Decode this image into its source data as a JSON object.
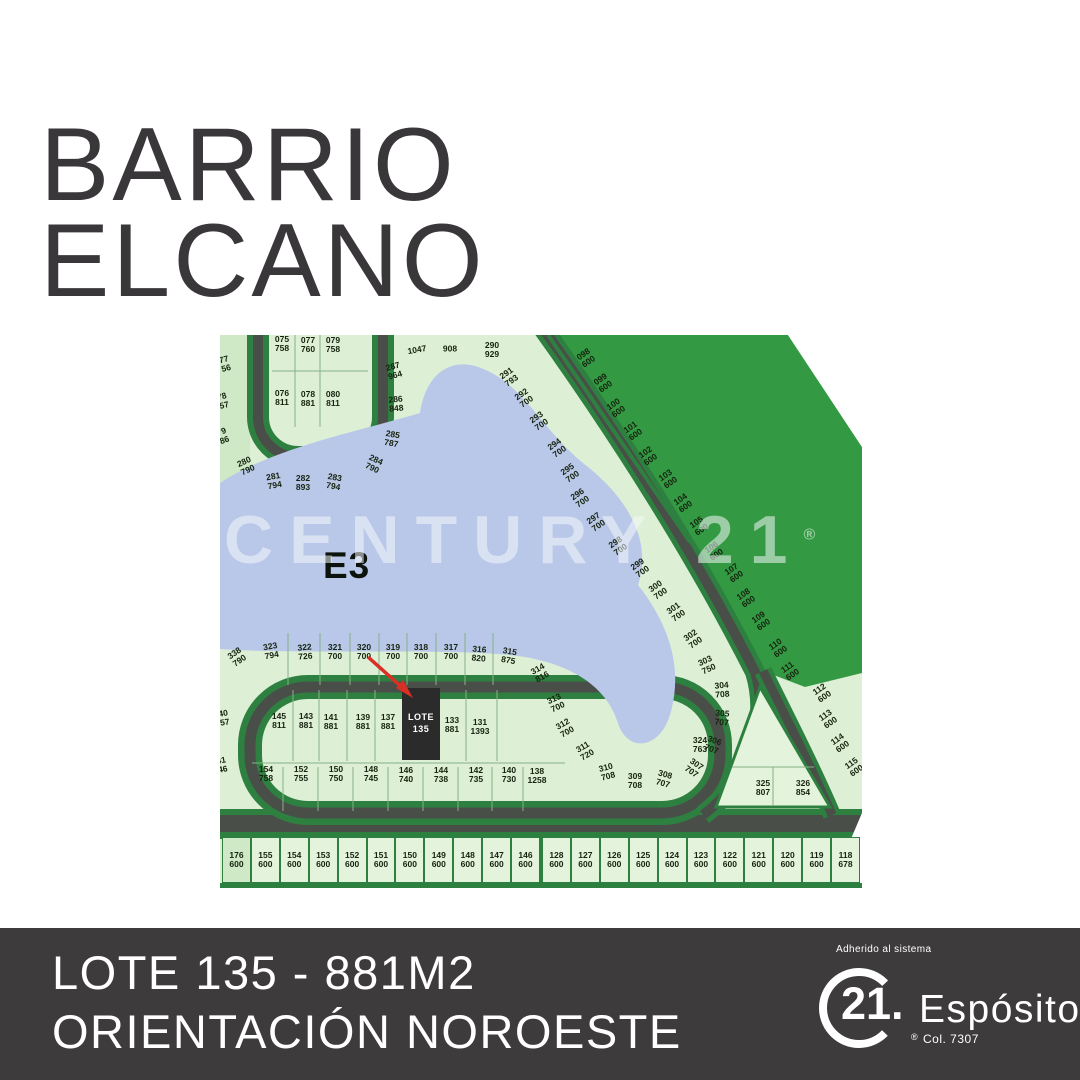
{
  "title": {
    "line1": "BARRIO",
    "line2": "ELCANO"
  },
  "footer": {
    "line1": "LOTE 135 - 881M2",
    "line2": "ORIENTACIÓN NOROESTE",
    "adherido": "Adherido al sistema",
    "brand": "21.",
    "registered": "®",
    "brand_name": "Espósito",
    "license": "Col. 7307"
  },
  "colors": {
    "page_bg": "#ffffff",
    "title_color": "#3a373a",
    "footer_bg": "#3e3b3c",
    "footer_text": "#ffffff",
    "map_base": "#ddefd5",
    "lot_fill": "#e4f3dc",
    "park_green": "#339a43",
    "road_gray": "#4a4e48",
    "road_green": "#2e8040",
    "lake_blue": "#b9c7e8",
    "label_color": "#16230f",
    "arrow_red": "#d93025",
    "selected_lot_bg": "#2b2b2b",
    "watermark_color": "rgba(244,248,250,0.55)"
  },
  "map": {
    "zone_label": "E3",
    "watermark": "CENTURY 21",
    "watermark_reg": "®",
    "selected_lot": {
      "line1": "LOTE",
      "line2": "135"
    },
    "lots": [
      {
        "n": "075",
        "a": "758",
        "x": 62,
        "y": 9,
        "r": 0
      },
      {
        "n": "077",
        "a": "760",
        "x": 88,
        "y": 10,
        "r": 0
      },
      {
        "n": "079",
        "a": "758",
        "x": 113,
        "y": 10,
        "r": 0
      },
      {
        "n": "076",
        "a": "811",
        "x": 62,
        "y": 63,
        "r": 0
      },
      {
        "n": "078",
        "a": "881",
        "x": 88,
        "y": 64,
        "r": 0
      },
      {
        "n": "080",
        "a": "811",
        "x": 113,
        "y": 64,
        "r": 0
      },
      {
        "n": "77",
        "a": "56",
        "x": 5,
        "y": 29,
        "r": -15
      },
      {
        "n": "78",
        "a": "57",
        "x": 3,
        "y": 66,
        "r": -15
      },
      {
        "n": "79",
        "a": "86",
        "x": 3,
        "y": 101,
        "r": -20
      },
      {
        "n": "287",
        "a": "964",
        "x": 174,
        "y": 36,
        "r": -15
      },
      {
        "n": "286",
        "a": "848",
        "x": 176,
        "y": 69,
        "r": -5
      },
      {
        "n": "285",
        "a": "787",
        "x": 172,
        "y": 104,
        "r": 10
      },
      {
        "n": "284",
        "a": "790",
        "x": 154,
        "y": 129,
        "r": 25
      },
      {
        "n": "280",
        "a": "790",
        "x": 26,
        "y": 131,
        "r": -25
      },
      {
        "n": "281",
        "a": "794",
        "x": 54,
        "y": 146,
        "r": -10
      },
      {
        "n": "282",
        "a": "893",
        "x": 83,
        "y": 148,
        "r": 0
      },
      {
        "n": "283",
        "a": "794",
        "x": 114,
        "y": 147,
        "r": 10
      },
      {
        "n": "1047",
        "a": "",
        "x": 197,
        "y": 15,
        "r": -10
      },
      {
        "n": "908",
        "a": "",
        "x": 230,
        "y": 14,
        "r": 0
      },
      {
        "n": "290",
        "a": "929",
        "x": 272,
        "y": 15,
        "r": 0
      },
      {
        "n": "291",
        "a": "793",
        "x": 289,
        "y": 42,
        "r": -35
      },
      {
        "n": "292",
        "a": "700",
        "x": 304,
        "y": 63,
        "r": -35
      },
      {
        "n": "293",
        "a": "700",
        "x": 319,
        "y": 86,
        "r": -35
      },
      {
        "n": "294",
        "a": "700",
        "x": 337,
        "y": 113,
        "r": -35
      },
      {
        "n": "295",
        "a": "700",
        "x": 350,
        "y": 138,
        "r": -35
      },
      {
        "n": "296",
        "a": "700",
        "x": 360,
        "y": 163,
        "r": -35
      },
      {
        "n": "297",
        "a": "700",
        "x": 376,
        "y": 187,
        "r": -35
      },
      {
        "n": "298",
        "a": "700",
        "x": 398,
        "y": 211,
        "r": -35
      },
      {
        "n": "299",
        "a": "700",
        "x": 420,
        "y": 233,
        "r": -35
      },
      {
        "n": "300",
        "a": "700",
        "x": 438,
        "y": 255,
        "r": -35
      },
      {
        "n": "301",
        "a": "700",
        "x": 456,
        "y": 277,
        "r": -35
      },
      {
        "n": "302",
        "a": "700",
        "x": 473,
        "y": 304,
        "r": -35
      },
      {
        "n": "303",
        "a": "750",
        "x": 487,
        "y": 330,
        "r": -25
      },
      {
        "n": "304",
        "a": "708",
        "x": 502,
        "y": 355,
        "r": -5
      },
      {
        "n": "305",
        "a": "707",
        "x": 502,
        "y": 383,
        "r": 5
      },
      {
        "n": "306",
        "a": "707",
        "x": 493,
        "y": 410,
        "r": 20
      },
      {
        "n": "307",
        "a": "707",
        "x": 474,
        "y": 433,
        "r": 35
      },
      {
        "n": "308",
        "a": "707",
        "x": 444,
        "y": 444,
        "r": 15
      },
      {
        "n": "309",
        "a": "708",
        "x": 415,
        "y": 446,
        "r": 0
      },
      {
        "n": "310",
        "a": "708",
        "x": 387,
        "y": 437,
        "r": -15
      },
      {
        "n": "311",
        "a": "720",
        "x": 365,
        "y": 416,
        "r": -30
      },
      {
        "n": "312",
        "a": "700",
        "x": 345,
        "y": 393,
        "r": -30
      },
      {
        "n": "313",
        "a": "700",
        "x": 336,
        "y": 368,
        "r": -25
      },
      {
        "n": "314",
        "a": "816",
        "x": 320,
        "y": 338,
        "r": -30
      },
      {
        "n": "098",
        "a": "600",
        "x": 366,
        "y": 23,
        "r": -35
      },
      {
        "n": "099",
        "a": "600",
        "x": 383,
        "y": 48,
        "r": -35
      },
      {
        "n": "100",
        "a": "600",
        "x": 396,
        "y": 73,
        "r": -35
      },
      {
        "n": "101",
        "a": "600",
        "x": 413,
        "y": 96,
        "r": -35
      },
      {
        "n": "102",
        "a": "600",
        "x": 428,
        "y": 121,
        "r": -35
      },
      {
        "n": "103",
        "a": "600",
        "x": 448,
        "y": 144,
        "r": -35
      },
      {
        "n": "104",
        "a": "600",
        "x": 463,
        "y": 168,
        "r": -35
      },
      {
        "n": "105",
        "a": "600",
        "x": 479,
        "y": 191,
        "r": -35
      },
      {
        "n": "106",
        "a": "600",
        "x": 494,
        "y": 216,
        "r": -35
      },
      {
        "n": "107",
        "a": "600",
        "x": 514,
        "y": 238,
        "r": -35
      },
      {
        "n": "108",
        "a": "600",
        "x": 526,
        "y": 263,
        "r": -35
      },
      {
        "n": "109",
        "a": "600",
        "x": 541,
        "y": 286,
        "r": -35
      },
      {
        "n": "110",
        "a": "600",
        "x": 558,
        "y": 313,
        "r": -35
      },
      {
        "n": "111",
        "a": "600",
        "x": 570,
        "y": 336,
        "r": -35
      },
      {
        "n": "112",
        "a": "600",
        "x": 602,
        "y": 358,
        "r": -35
      },
      {
        "n": "113",
        "a": "600",
        "x": 608,
        "y": 384,
        "r": -35
      },
      {
        "n": "114",
        "a": "600",
        "x": 620,
        "y": 408,
        "r": -35
      },
      {
        "n": "115",
        "a": "600",
        "x": 634,
        "y": 432,
        "r": -35
      },
      {
        "n": "338",
        "a": "790",
        "x": 17,
        "y": 322,
        "r": -35
      },
      {
        "n": "323",
        "a": "794",
        "x": 51,
        "y": 316,
        "r": -10
      },
      {
        "n": "322",
        "a": "726",
        "x": 85,
        "y": 317,
        "r": -5
      },
      {
        "n": "321",
        "a": "700",
        "x": 115,
        "y": 317,
        "r": 0
      },
      {
        "n": "320",
        "a": "700",
        "x": 144,
        "y": 317,
        "r": 0
      },
      {
        "n": "319",
        "a": "700",
        "x": 173,
        "y": 317,
        "r": 0
      },
      {
        "n": "318",
        "a": "700",
        "x": 201,
        "y": 317,
        "r": 0
      },
      {
        "n": "317",
        "a": "700",
        "x": 231,
        "y": 317,
        "r": 0
      },
      {
        "n": "316",
        "a": "820",
        "x": 259,
        "y": 319,
        "r": 5
      },
      {
        "n": "315",
        "a": "875",
        "x": 289,
        "y": 321,
        "r": 10
      },
      {
        "n": "145",
        "a": "811",
        "x": 59,
        "y": 386,
        "r": 0
      },
      {
        "n": "143",
        "a": "881",
        "x": 86,
        "y": 386,
        "r": 0
      },
      {
        "n": "141",
        "a": "881",
        "x": 111,
        "y": 387,
        "r": 0
      },
      {
        "n": "139",
        "a": "881",
        "x": 143,
        "y": 387,
        "r": 0
      },
      {
        "n": "137",
        "a": "881",
        "x": 168,
        "y": 387,
        "r": 0
      },
      {
        "n": "133",
        "a": "881",
        "x": 232,
        "y": 390,
        "r": 0
      },
      {
        "n": "131",
        "a": "1393",
        "x": 260,
        "y": 392,
        "r": 0
      },
      {
        "n": "154",
        "a": "758",
        "x": 46,
        "y": 439,
        "r": 0
      },
      {
        "n": "152",
        "a": "755",
        "x": 81,
        "y": 439,
        "r": 0
      },
      {
        "n": "150",
        "a": "750",
        "x": 116,
        "y": 439,
        "r": 0
      },
      {
        "n": "148",
        "a": "745",
        "x": 151,
        "y": 439,
        "r": 0
      },
      {
        "n": "146",
        "a": "740",
        "x": 186,
        "y": 440,
        "r": 0
      },
      {
        "n": "144",
        "a": "738",
        "x": 221,
        "y": 440,
        "r": 0
      },
      {
        "n": "142",
        "a": "735",
        "x": 256,
        "y": 440,
        "r": 0
      },
      {
        "n": "140",
        "a": "730",
        "x": 289,
        "y": 440,
        "r": 0
      },
      {
        "n": "138",
        "a": "1258",
        "x": 317,
        "y": 441,
        "r": 0
      },
      {
        "n": "40",
        "a": "57",
        "x": 4,
        "y": 383,
        "r": -10
      },
      {
        "n": "41",
        "a": "46",
        "x": 2,
        "y": 430,
        "r": -10
      },
      {
        "n": "324",
        "a": "763",
        "x": 480,
        "y": 410,
        "r": 0
      },
      {
        "n": "325",
        "a": "807",
        "x": 543,
        "y": 453,
        "r": 0
      },
      {
        "n": "326",
        "a": "854",
        "x": 583,
        "y": 453,
        "r": 0
      }
    ],
    "strip": [
      {
        "n": "176",
        "a": "600"
      },
      {
        "n": "155",
        "a": "600"
      },
      {
        "n": "154",
        "a": "600"
      },
      {
        "n": "153",
        "a": "600"
      },
      {
        "n": "152",
        "a": "600"
      },
      {
        "n": "151",
        "a": "600"
      },
      {
        "n": "150",
        "a": "600"
      },
      {
        "n": "149",
        "a": "600"
      },
      {
        "n": "148",
        "a": "600"
      },
      {
        "n": "147",
        "a": "600"
      },
      {
        "n": "146",
        "a": "600"
      },
      {
        "n": "128",
        "a": "600"
      },
      {
        "n": "127",
        "a": "600"
      },
      {
        "n": "126",
        "a": "600"
      },
      {
        "n": "125",
        "a": "600"
      },
      {
        "n": "124",
        "a": "600"
      },
      {
        "n": "123",
        "a": "600"
      },
      {
        "n": "122",
        "a": "600"
      },
      {
        "n": "121",
        "a": "600"
      },
      {
        "n": "120",
        "a": "600"
      },
      {
        "n": "119",
        "a": "600"
      },
      {
        "n": "118",
        "a": "678"
      }
    ]
  }
}
